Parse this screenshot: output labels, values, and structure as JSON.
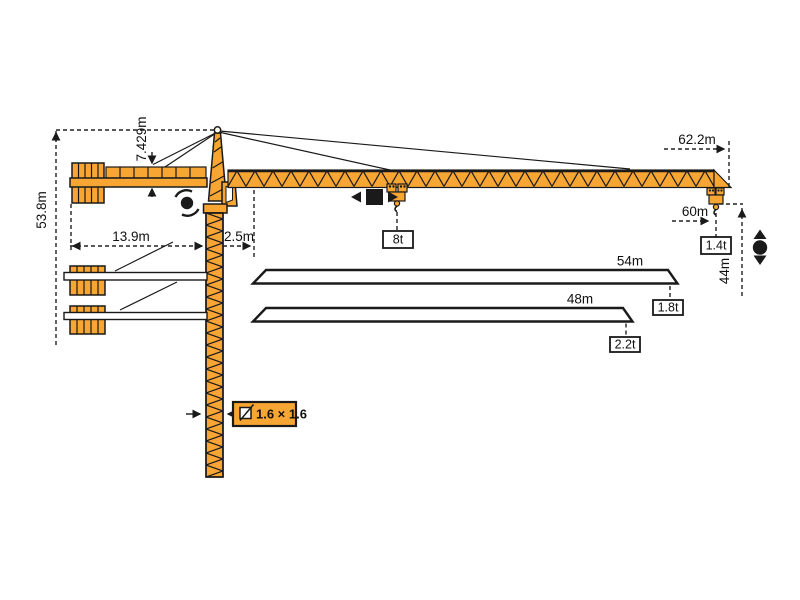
{
  "diagram_type": "tower-crane-load-diagram",
  "colors": {
    "crane_orange": "#F7A533",
    "line_black": "#1A1A1A",
    "background": "#FFFFFF"
  },
  "dimensions": {
    "height_total": "53.8m",
    "apex_height": "7.429m",
    "counterjib_radius": "13.9m",
    "min_radius": "2.5m",
    "jib_overall_length": "62.2m",
    "max_radius": "60m",
    "hook_height": "44m",
    "mast_section": "1.6 × 1.6"
  },
  "capacities": {
    "tip_at_max_radius": "1.4t",
    "max_load": "8t"
  },
  "jib_variants": [
    {
      "length": "54m",
      "tip_capacity": "1.8t"
    },
    {
      "length": "48m",
      "tip_capacity": "2.2t"
    }
  ],
  "icons": [
    "slewing-icon",
    "trolley-travel-icon",
    "hoisting-icon",
    "mast-section-icon"
  ]
}
